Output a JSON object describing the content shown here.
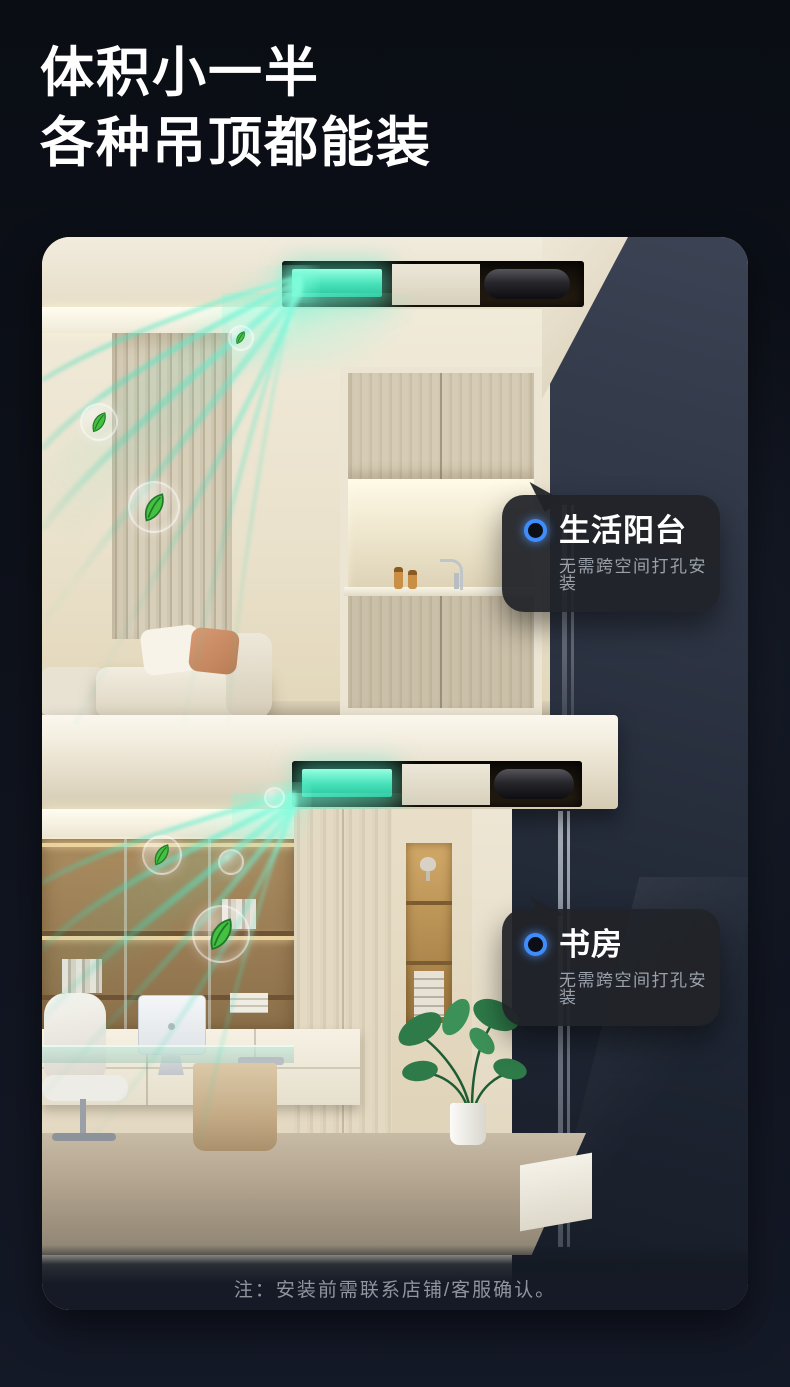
{
  "header": {
    "title_line1": "体积小一半",
    "title_line2": "各种吊顶都能装"
  },
  "scene": {
    "rooms": [
      {
        "title": "生活阳台",
        "subtitle": "无需跨空间打孔安装"
      },
      {
        "title": "书房",
        "subtitle": "无需跨空间打孔安装"
      }
    ],
    "note": "注：安装前需联系店铺/客服确认。"
  },
  "icons": {
    "callout_marker": "blue-ring-dot-icon",
    "bubble_leaf": "leaf-icon",
    "device_light": "fresh-air-unit-glow"
  },
  "colors": {
    "page_bg": "#0e121b",
    "title_text": "#ffffff",
    "callout_bg": "rgba(33,35,40,0.94)",
    "callout_title": "#ffffff",
    "callout_subtitle": "#9aa1ab",
    "marker_blue": "#3f8cfa",
    "airflow_green": "#45e0b8",
    "note_text": "#8f949e"
  }
}
